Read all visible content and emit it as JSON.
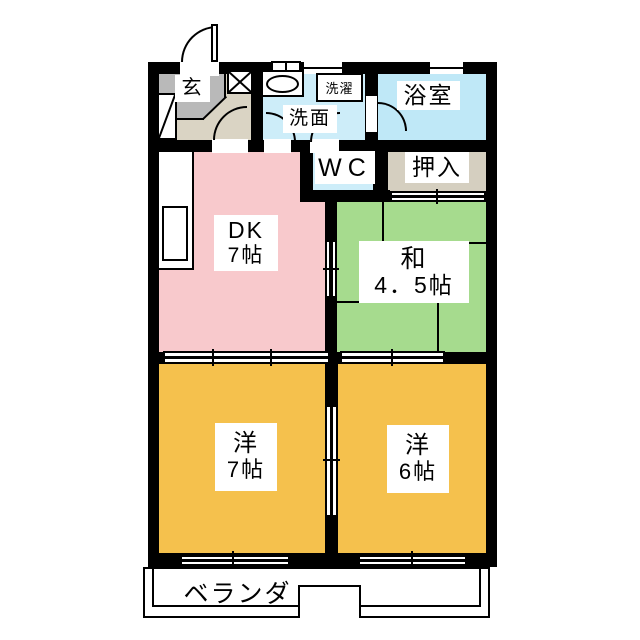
{
  "plan_title": "2DK apartment floor plan",
  "palette": {
    "wall": "#000000",
    "dk_pink": "#F8C9CC",
    "tatami_green": "#A6DB8E",
    "bedroom_orange": "#F5C14D",
    "washroom_blue": "#CDEDF9",
    "bathroom_blue": "#BFE8F7",
    "wc_blue": "#CDEDF9",
    "closet_beige": "#D5CFC0",
    "genkan_tile_gray": "#B9B9B9",
    "genkan_floor_beige": "#DAD4C4"
  },
  "rooms": {
    "genkan": {
      "label": "玄"
    },
    "washroom": {
      "label": "洗面"
    },
    "laundry": {
      "label": "洗濯"
    },
    "bathroom": {
      "label": "浴室"
    },
    "wc": {
      "label": "WC"
    },
    "oshiire": {
      "label": "押入"
    },
    "dk": {
      "label": "DK",
      "size": "7帖"
    },
    "washitsu": {
      "label": "和",
      "size": "4．5帖"
    },
    "western7": {
      "label": "洋",
      "size": "7帖"
    },
    "western6": {
      "label": "洋",
      "size": "6帖"
    },
    "veranda": {
      "label": "ベランダ"
    }
  }
}
